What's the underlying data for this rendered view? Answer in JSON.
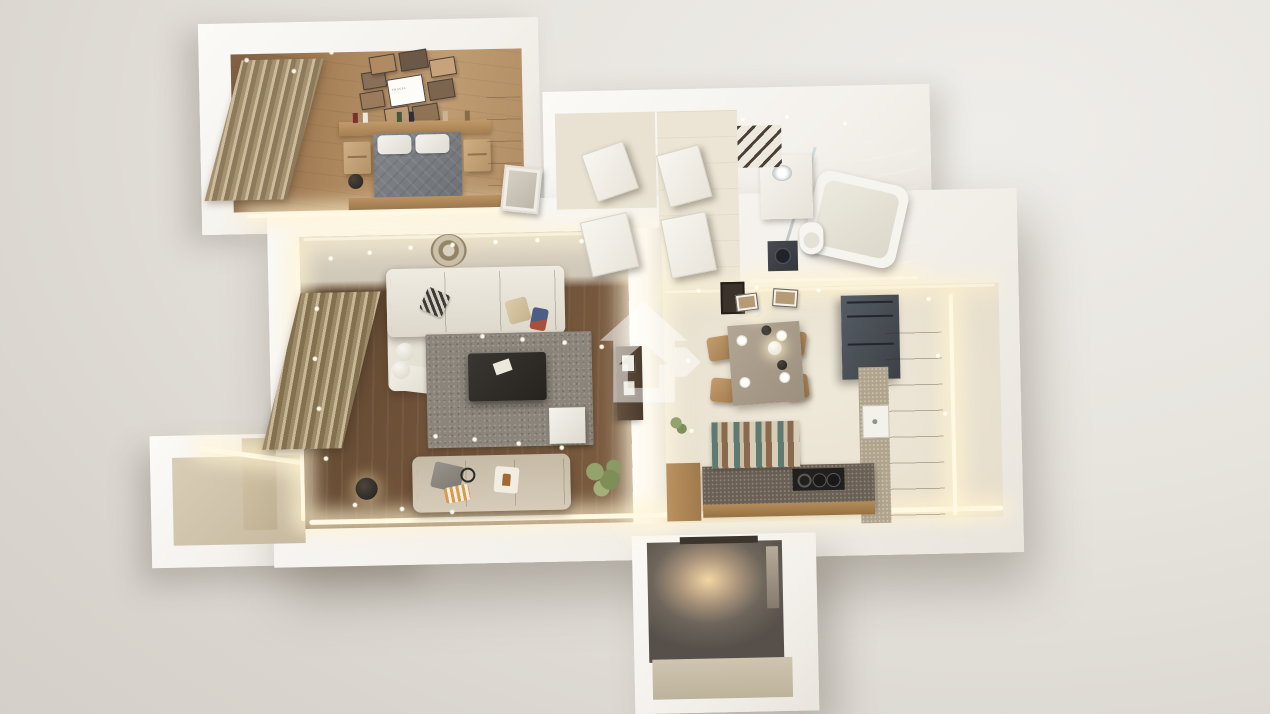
{
  "scene": {
    "type": "3d-floorplan-render",
    "description": "Top-down 3D render of a furnished one-bedroom apartment with warm LED cove lighting",
    "poster_text": "TRAVEL",
    "watermark": {
      "icon": "house-arrow-watermark",
      "color": "#ffffff",
      "opacity": "0.5"
    }
  },
  "palette": {
    "background": "#e0dcd6",
    "walls": "#f6f4f0",
    "led_glow": "#fff3d8",
    "bedroom_wood_floor": "#b08a62",
    "living_dark_floor": "#6b5039",
    "tile_floor": "#e9e2d2",
    "rug_gray": "#8b857b",
    "sofa_cream": "#e9e5da",
    "cabinet_wood": "#b28c60",
    "appliance_dark": "#41464d",
    "entry_wall": "#6e665c"
  },
  "bedroom": {
    "label": "bedroom",
    "curtains": "curtains",
    "gallery_wall": "gallery wall with photo frames",
    "poster_text": "TRAVEL",
    "shelf": "headboard shelf with books",
    "bed": "double bed",
    "pillow_left": "pillow",
    "pillow_right": "pillow",
    "nightstand_left": "nightstand",
    "nightstand_right": "nightstand",
    "bench": "bed-end bench",
    "wardrobe": "wardrobe",
    "mirror": "leaning mirror",
    "lamp": "floor lamp"
  },
  "living_room": {
    "label": "living room",
    "ceiling_medallion": "ceiling medallion",
    "curtains": "curtains",
    "sectional_sofa": "corner sofa",
    "chaise": "chaise lounge",
    "throw": "throw blanket",
    "pillow_patterned": "patterned pillow",
    "pillow_tan": "tan pillow",
    "pillow_navy": "navy pillow",
    "poufs": "poufs",
    "rug": "gray area rug",
    "coffee_table": "coffee table",
    "sofa_bottom": "sofa",
    "blanket": "gray blanket",
    "pillow_striped": "striped pillow",
    "pillow_deer": "deer print pillow",
    "headphones": "headphones",
    "cube_table": "cube side table",
    "plant": "potted plant",
    "floor_lamp": "floor lamp",
    "tv_console": "tv console with frames",
    "bright_wall": "illuminated partition wall"
  },
  "hallway": {
    "label": "hallway",
    "door_1": "interior door",
    "door_2": "interior door",
    "door_3": "interior door",
    "door_4": "interior door",
    "frame": "leaning picture frame"
  },
  "bathroom": {
    "label": "bathroom",
    "tile_wall": "tiled wall",
    "bathtub": "bathtub",
    "shower_glass": "glass shower screen",
    "vanity": "vanity with basin",
    "towel_ladder": "towel ladder",
    "toilet": "toilet",
    "washing_machine": "washing machine"
  },
  "kitchen": {
    "label": "kitchen and dining",
    "dining_table": "dining table with place settings",
    "chair": "dining chair",
    "pendants": "pendant lights",
    "rug": "striped runner rug",
    "fridge": "fridge and oven column",
    "cabinets": "cabinet run",
    "counter": "countertop",
    "sink": "sink",
    "peninsula": "peninsula counter",
    "cooktop": "cooktop",
    "frames": "wall frames",
    "side_cabinet": "side cabinet",
    "plant": "plant"
  },
  "balcony": {
    "label": "balcony",
    "parapet": "parapet wall",
    "floor": "balcony floor",
    "pillar": "corner pillar"
  },
  "entrance": {
    "label": "entrance",
    "niche": "entry niche with wall light",
    "lintel": "entry door lintel",
    "window": "window slit",
    "floor": "entry landing"
  }
}
